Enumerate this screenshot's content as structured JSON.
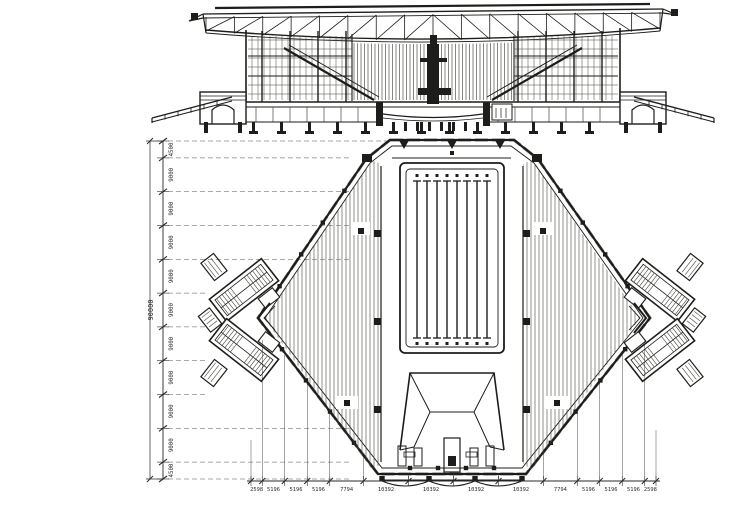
{
  "drawing": {
    "kind": "architectural plan and section, scanned ink drawing",
    "sheet_background": "#ffffff"
  },
  "dimensions": {
    "left": {
      "orientation": "vertical",
      "total": "90000",
      "segments": [
        "4500",
        "9000",
        "9000",
        "9000",
        "9000",
        "9000",
        "9000",
        "9000",
        "9000",
        "9000",
        "4500"
      ]
    },
    "bottom": {
      "orientation": "horizontal",
      "segments": [
        "2598",
        "5196",
        "5196",
        "5196",
        "7794",
        "10392",
        "10392",
        "10392",
        "10392",
        "7794",
        "5196",
        "5196",
        "5196",
        "2598"
      ]
    }
  },
  "colors": {
    "ink": "#1d1d1b",
    "hatch": "#45453f",
    "dim_line": "#2a2a28",
    "paper": "#ffffff"
  }
}
